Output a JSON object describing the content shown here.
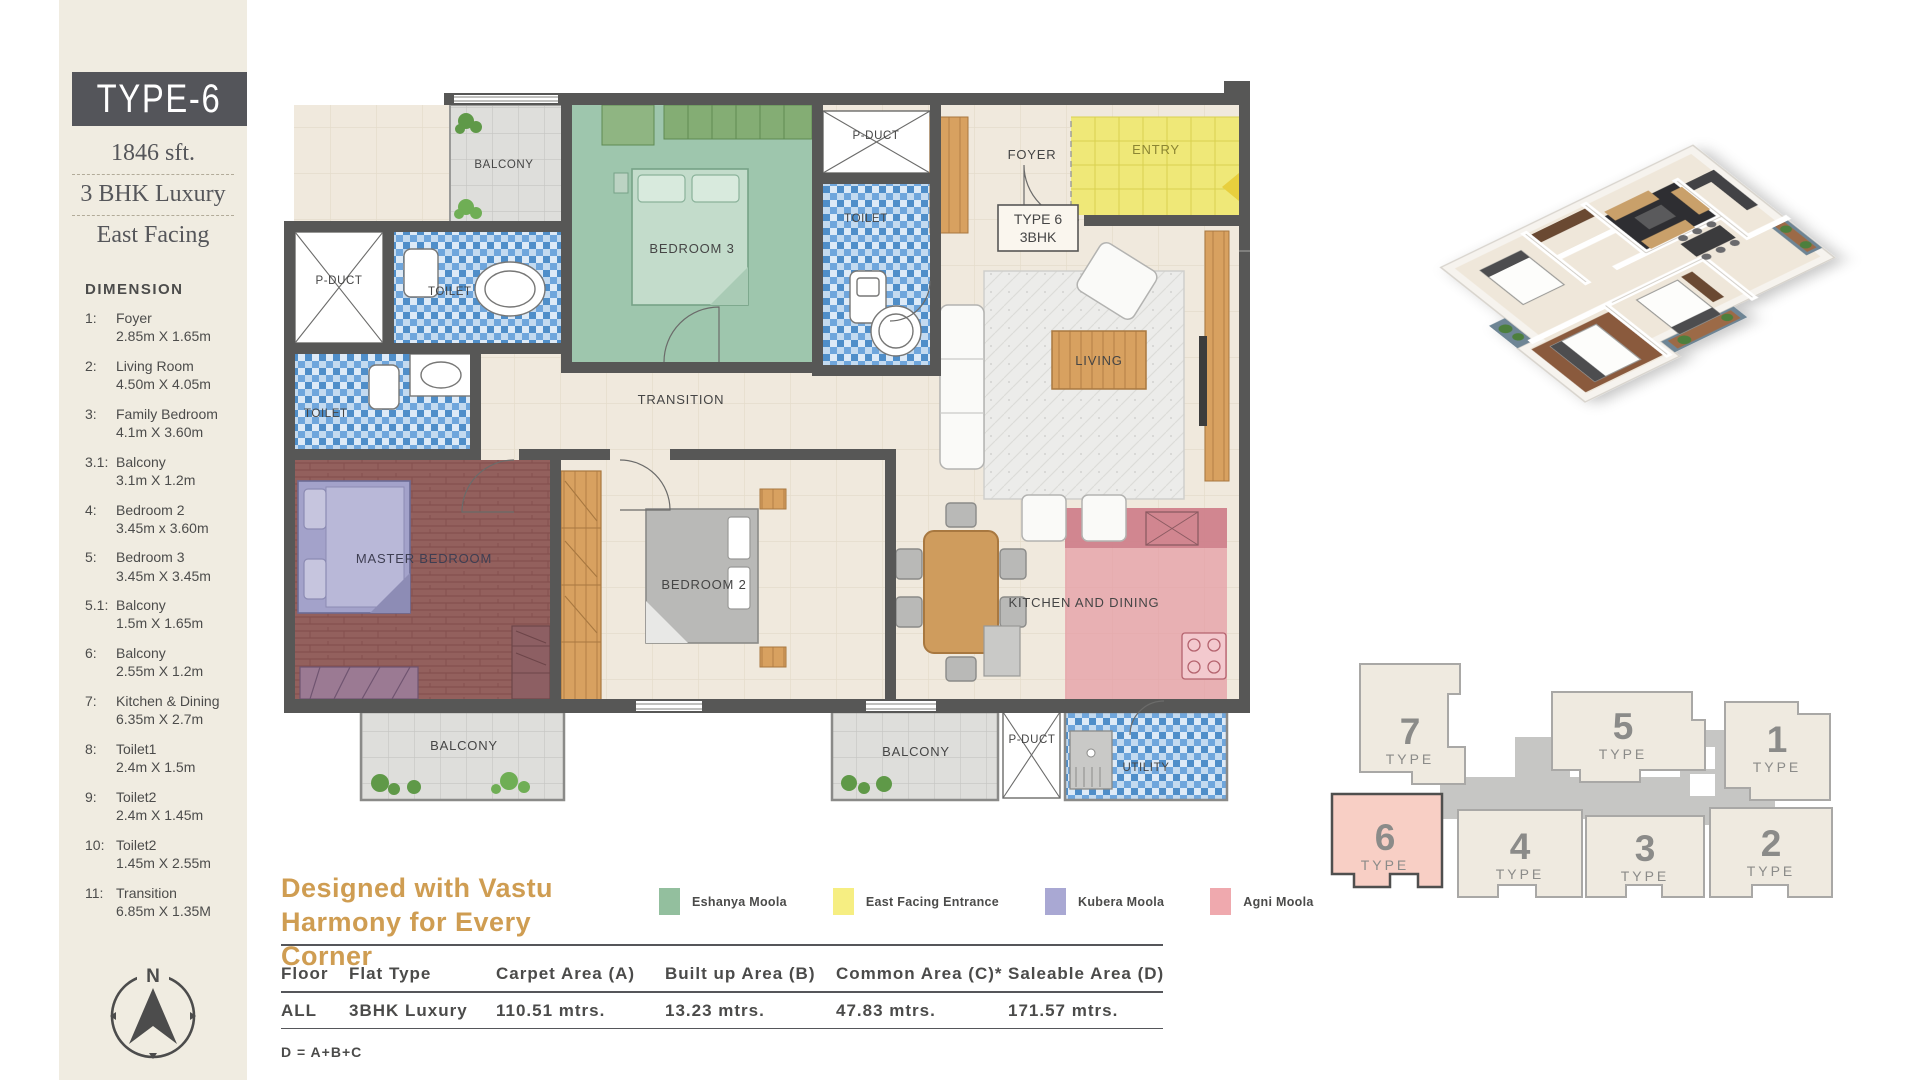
{
  "sidebar": {
    "type_title": "TYPE-6",
    "area": "1846 sft.",
    "flat_type": "3 BHK Luxury",
    "facing": "East Facing",
    "dimension_heading": "DIMENSION",
    "dimensions": [
      {
        "no": "1:",
        "name": "Foyer",
        "size": "2.85m X 1.65m"
      },
      {
        "no": "2:",
        "name": "Living Room",
        "size": "4.50m X 4.05m"
      },
      {
        "no": "3:",
        "name": "Family Bedroom",
        "size": "4.1m X 3.60m"
      },
      {
        "no": "3.1:",
        "name": "Balcony",
        "size": "3.1m X 1.2m"
      },
      {
        "no": "4:",
        "name": "Bedroom 2",
        "size": "3.45m x 3.60m"
      },
      {
        "no": "5:",
        "name": "Bedroom 3",
        "size": "3.45m X 3.45m"
      },
      {
        "no": "5.1:",
        "name": "Balcony",
        "size": "1.5m X 1.65m"
      },
      {
        "no": "6:",
        "name": "Balcony",
        "size": "2.55m X 1.2m"
      },
      {
        "no": "7:",
        "name": "Kitchen & Dining",
        "size": "6.35m X 2.7m"
      },
      {
        "no": "8:",
        "name": "Toilet1",
        "size": "2.4m X 1.5m"
      },
      {
        "no": "9:",
        "name": "Toilet2",
        "size": "2.4m X 1.45m"
      },
      {
        "no": "10:",
        "name": "Toilet2",
        "size": "1.45m X 2.55m"
      },
      {
        "no": "11:",
        "name": "Transition",
        "size": "6.85m X 1.35M"
      }
    ],
    "compass_label": "N"
  },
  "floor_plan": {
    "tag_line1": "TYPE 6",
    "tag_line2": "3BHK",
    "rooms": {
      "balcony_top": "BALCONY",
      "bedroom3": "BEDROOM 3",
      "pduct_top": "P-DUCT",
      "toilet_top": "TOILET",
      "foyer": "FOYER",
      "entry": "ENTRY",
      "living": "LIVING",
      "pduct_left": "P-DUCT",
      "toilet_left": "TOILET",
      "toilet_lower": "TOILET",
      "transition": "TRANSITION",
      "master_bedroom": "MASTER BEDROOM",
      "bedroom2": "BEDROOM 2",
      "kitchen": "KITCHEN AND DINING",
      "balcony_bottom_left": "BALCONY",
      "balcony_bottom_center": "BALCONY",
      "pduct_bottom": "P-DUCT",
      "utility": "UTILITY"
    }
  },
  "vastu": {
    "title_line1": "Designed with Vastu",
    "title_line2": "Harmony for Every Corner",
    "legend": [
      {
        "label": "Eshanya Moola",
        "color": "#93bf9e"
      },
      {
        "label": "East Facing Entrance",
        "color": "#f6ee82"
      },
      {
        "label": "Kubera Moola",
        "color": "#a9a8d3"
      },
      {
        "label": "Agni Moola",
        "color": "#efa9ae"
      }
    ]
  },
  "area_table": {
    "headers": [
      "Floor",
      "Flat Type",
      "Carpet Area (A)",
      "Built up Area (B)",
      "Common Area (C)*",
      "Saleable Area (D)"
    ],
    "row": [
      "ALL",
      "3BHK Luxury",
      "110.51 mtrs.",
      "13.23 mtrs.",
      "47.83 mtrs.",
      "171.57 mtrs."
    ],
    "footnote": "D = A+B+C"
  },
  "key_plan": {
    "units": [
      {
        "num": "7",
        "word": "TYPE",
        "highlighted": false
      },
      {
        "num": "5",
        "word": "TYPE",
        "highlighted": false
      },
      {
        "num": "1",
        "word": "TYPE",
        "highlighted": false
      },
      {
        "num": "6",
        "word": "TYPE",
        "highlighted": true
      },
      {
        "num": "4",
        "word": "TYPE",
        "highlighted": false
      },
      {
        "num": "3",
        "word": "TYPE",
        "highlighted": false
      },
      {
        "num": "2",
        "word": "TYPE",
        "highlighted": false
      }
    ],
    "highlight_color": "#f8cfc5"
  },
  "colors": {
    "wall": "#575756",
    "sidebar_bg": "#f0ece1",
    "banner_bg": "#54555a",
    "accent_gold": "#cf9d52"
  }
}
